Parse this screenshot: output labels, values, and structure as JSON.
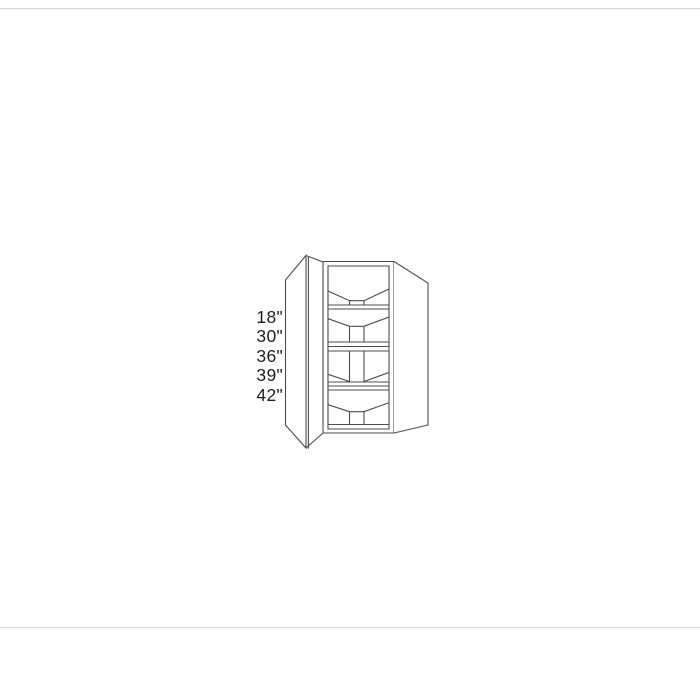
{
  "figure": {
    "type": "line-drawing",
    "subject": "diagonal-corner-wall-cabinet-with-open-door-and-shelves",
    "height_options": [
      "18\"",
      "30\"",
      "36\"",
      "39\"",
      "42\""
    ],
    "colors": {
      "background": "#ffffff",
      "line": "#4d4d4d",
      "label_text": "#1e1e1e",
      "border_rule": "#d8d8d8"
    }
  }
}
